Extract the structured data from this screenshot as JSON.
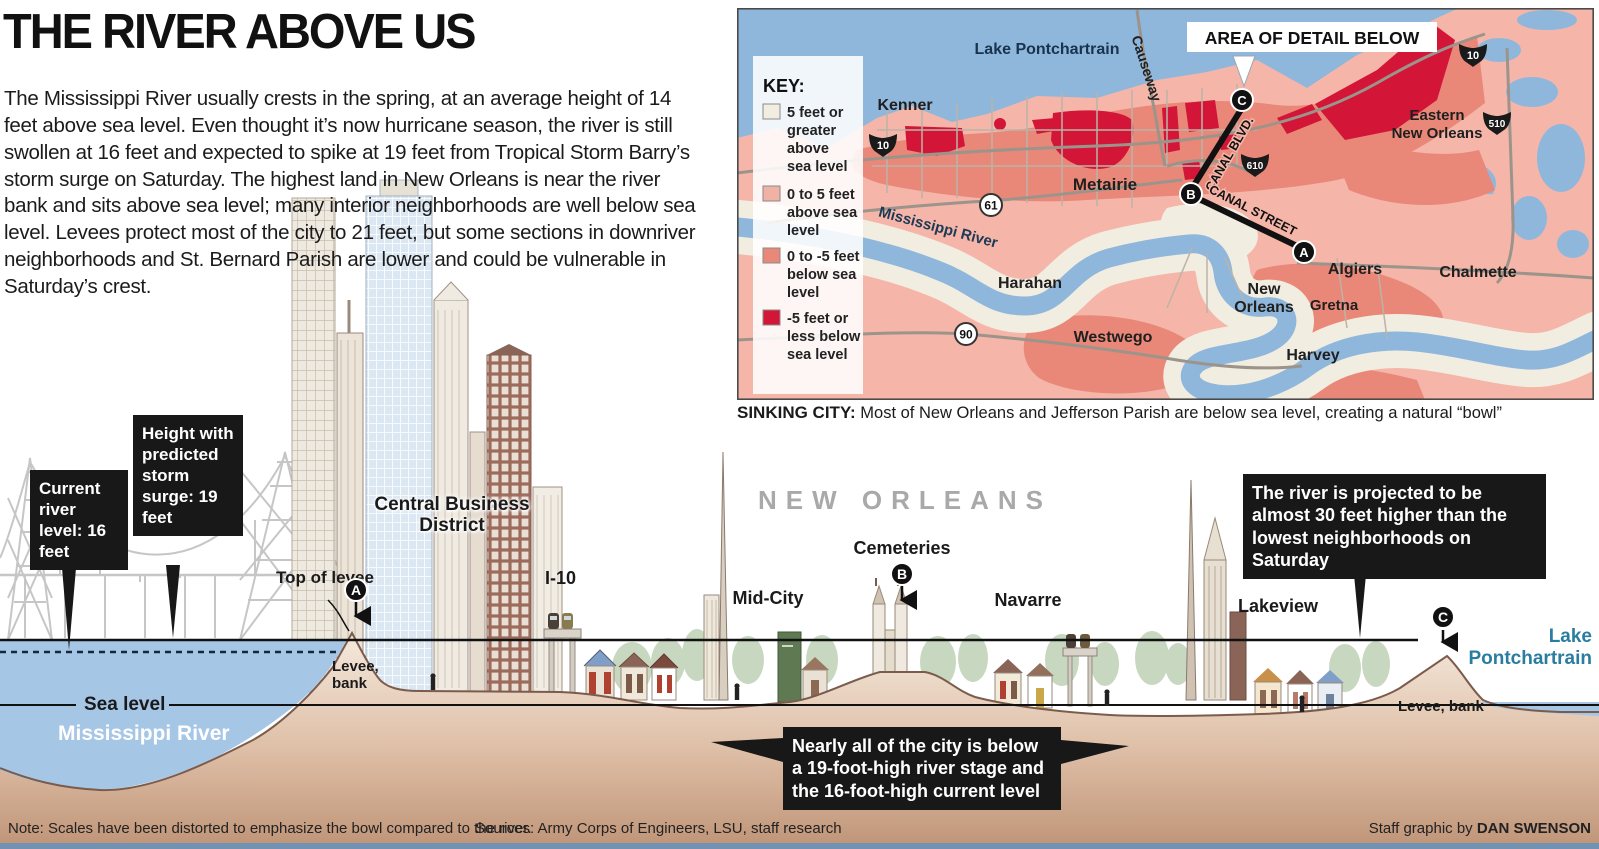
{
  "title": "THE RIVER ABOVE US",
  "intro": "The Mississippi River usually crests in the spring, at an average height of 14 feet above sea level. Even thought it’s now hurricane season, the river is still swollen at 16 feet and expected to spike at 19 feet from Tropical Storm Barry’s storm surge on Saturday. The highest land in New Orleans is near the river bank and sits above sea level; many interior neighborhoods are well below sea level. Levees protect most of the city to 21 feet, but some sections in downriver neighborhoods and St. Bernard Parish are lower and could be vulnerable in Saturday’s crest.",
  "map": {
    "area_of_detail": "AREA OF DETAIL BELOW",
    "key": {
      "heading": "KEY:",
      "items": [
        {
          "color": "#f2ede1",
          "lines": [
            "5 feet or",
            "greater",
            "above",
            "sea level"
          ]
        },
        {
          "color": "#f0b2a4",
          "lines": [
            "0 to 5 feet",
            "above sea",
            "level",
            ""
          ]
        },
        {
          "color": "#e98878",
          "lines": [
            "0 to -5 feet",
            "below sea",
            "level",
            ""
          ]
        },
        {
          "color": "#d31638",
          "lines": [
            "-5 feet or",
            "less below",
            "sea level",
            ""
          ]
        }
      ]
    },
    "labels": {
      "lake": "Lake Pontchartrain",
      "causeway": "Causeway",
      "kenner": "Kenner",
      "metairie": "Metairie",
      "river": "Mississippi River",
      "harahan": "Harahan",
      "westwego": "Westwego",
      "new_orleans_1": "New",
      "new_orleans_2": "Orleans",
      "algiers": "Algiers",
      "gretna": "Gretna",
      "harvey": "Harvey",
      "chalmette": "Chalmette",
      "eastern_1": "Eastern",
      "eastern_2": "New Orleans",
      "canal_blvd": "CANAL BLVD.",
      "canal_street": "CANAL STREET"
    },
    "shields": {
      "i10": "10",
      "i510": "510",
      "i610": "610",
      "us61": "61",
      "us90": "90"
    },
    "markers": {
      "a": "A",
      "b": "B",
      "c": "C"
    }
  },
  "caption": {
    "lead": "SINKING CITY:",
    "text": " Most of New Orleans and Jefferson Parish are below sea level, creating a natural “bowl”"
  },
  "cross_section": {
    "callout_current": "Current river level: 16 feet",
    "callout_surge": "Height with predicted storm surge: 19 feet",
    "callout_projection": "The river is projected to be almost 30 feet higher than the lowest neighborhoods on Saturday",
    "callout_bowl": "Nearly all of the city is below a 19-foot-high river stage and the 16-foot-high current level",
    "top_of_levee": "Top of levee",
    "levee_bank_left": "Levee, bank",
    "levee_bank_right": "Levee, bank",
    "sea_level": "Sea level",
    "mississippi_river": "Mississippi River",
    "new_orleans": "NEW ORLEANS",
    "cbd_1": "Central Business",
    "cbd_2": "District",
    "i10": "I-10",
    "mid_city": "Mid-City",
    "cemeteries": "Cemeteries",
    "navarre": "Navarre",
    "lakeview": "Lakeview",
    "lake_1": "Lake",
    "lake_2": "Pontchartrain",
    "markers": {
      "a": "A",
      "b": "B",
      "c": "C"
    }
  },
  "footer": {
    "note": "Note: Scales have been distorted to emphasize the bowl compared to the river.",
    "sources": "Sources: Army Corps of Engineers, LSU, staff research",
    "credit_prefix": "Staff graphic by ",
    "credit_name": "DAN SWENSON"
  },
  "colors": {
    "crimson": "#d31638",
    "salmon": "#e98878",
    "land_pink": "#f5b6a9",
    "cream": "#f2ede1",
    "water": "#8fb7dc",
    "ground_dark": "#c09579",
    "callout_bg": "#181818",
    "teal_label": "#2a7da0"
  }
}
